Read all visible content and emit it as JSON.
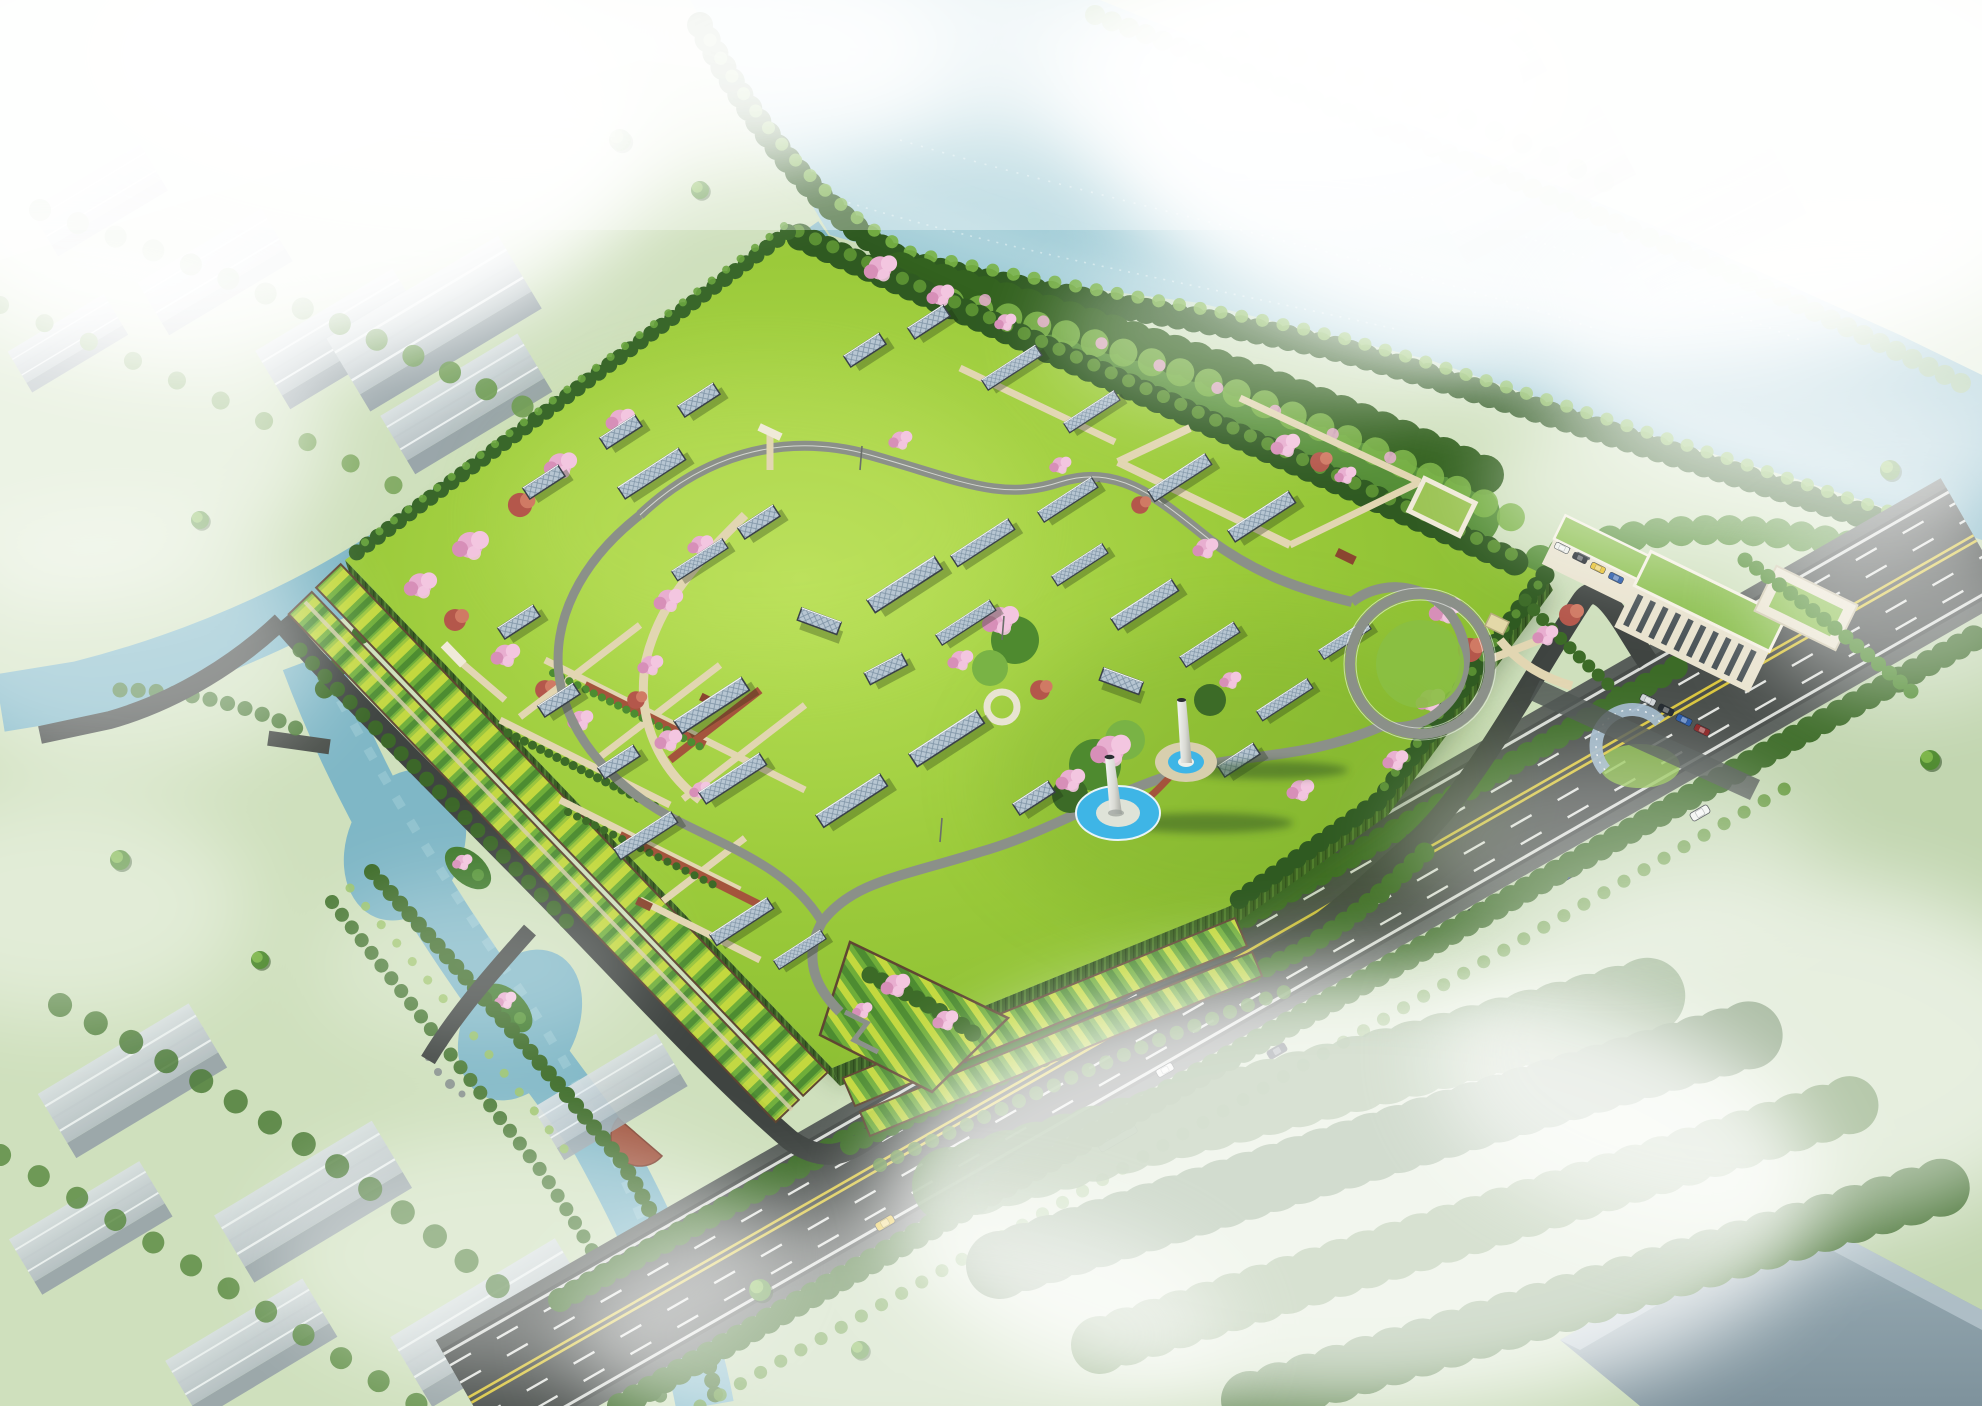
{
  "title": "Aerial rendering of a riverside green-roof park (water treatment facility) with winding paths, skylight panels, twin stacks and surrounding roads",
  "palette": {
    "terrain": "#cfe0bd",
    "terrain_pale": "#dce8d2",
    "river": "#a3c9d4",
    "river_deep": "#84b4c4",
    "canal": "#7fb7c6",
    "lawn": "#9ccb3b",
    "lawn_light": "#b4dc55",
    "lawn_dark": "#7db32f",
    "hedge": "#3c6b27",
    "tree_dark": "#2f5a21",
    "tree_mid": "#4e8a2f",
    "tree_light": "#79b345",
    "tree_pale": "#8fb573",
    "blossom_pink": "#e8aed0",
    "blossom_light": "#f3c6e0",
    "leaf_red": "#b4574b",
    "terrace_yellow": "#c3d83e",
    "terrace_green": "#6fae39",
    "terrace_dark": "#4d8c31",
    "soil_brown": "#5f4632",
    "wall_green": "#3a5f25",
    "path_beige": "#e2d6b2",
    "path_gray": "#8b9089",
    "path_red": "#a4543c",
    "road_dark": "#474c49",
    "road_light": "#575d59",
    "peri_road": "#3f4441",
    "lane_white": "#f2f4f0",
    "lane_yellow": "#d9c53e",
    "panel_blue": "#b7c6d2",
    "panel_grid": "#7e93a5",
    "panel_frame": "#394049",
    "warehouse_roof": "#ccd5d9",
    "warehouse_side": "#97a3a9",
    "building_wall": "#e9e3cf",
    "building_roof": "#8bbf4e",
    "window_dark": "#4a5357",
    "pool_blue": "#3eb5e6",
    "deck_red": "#9e4f38",
    "tower_white": "#e6e7e2",
    "shadow_green": "#2e5220",
    "pergola_blue": "#9fb6c8",
    "bus_white": "#eef0ec",
    "taxi_yellow": "#e8c12e",
    "car_teal": "#2e8ea6",
    "car_blue": "#2456a8",
    "car_dark": "#16202c",
    "car_red": "#8a2020"
  },
  "scene": {
    "setting": "misty aerial view, large river at top, canals on west and south, multi-lane highway crossing lower right",
    "park": {
      "shape": "elevated quadrilateral green roof with vegetated walls",
      "features": [
        "perimeter tree hedge",
        "terraced planting strips on southwest and southeast slopes",
        "winding gray loop path",
        "beige garden paths and brick-red parterre paths",
        "scattered diamond-grid skylight panels",
        "cherry-blossom tree clusters",
        "two white exhaust stacks with circular blue pools",
        "circular ring path around mound",
        "curved blue pergola at east corner",
        "west entrance gate and south ramp garden"
      ],
      "skylight_panel_count": 36
    },
    "buildings_east": [
      "office block with vertical window slits and green roof",
      "two-storey annex with green roof",
      "walled courtyard building",
      "gate courtyard",
      "kiosk"
    ],
    "surroundings": [
      "gray warehouse rows top-left and bottom-left",
      "faint warehouses in mist top-right",
      "large gray building bottom-right",
      "tree belts along banks and roads",
      "two islands with blossoms in the south canal",
      "red semicircular deck on canal bank"
    ],
    "vehicles_highway": [
      "yellow taxi",
      "white car",
      "white bus",
      "teal car",
      "dark sedans",
      "blue car"
    ],
    "vehicles_parking": [
      "white van",
      "black car",
      "yellow car",
      "blue car",
      "silver car",
      "dark red car"
    ]
  }
}
